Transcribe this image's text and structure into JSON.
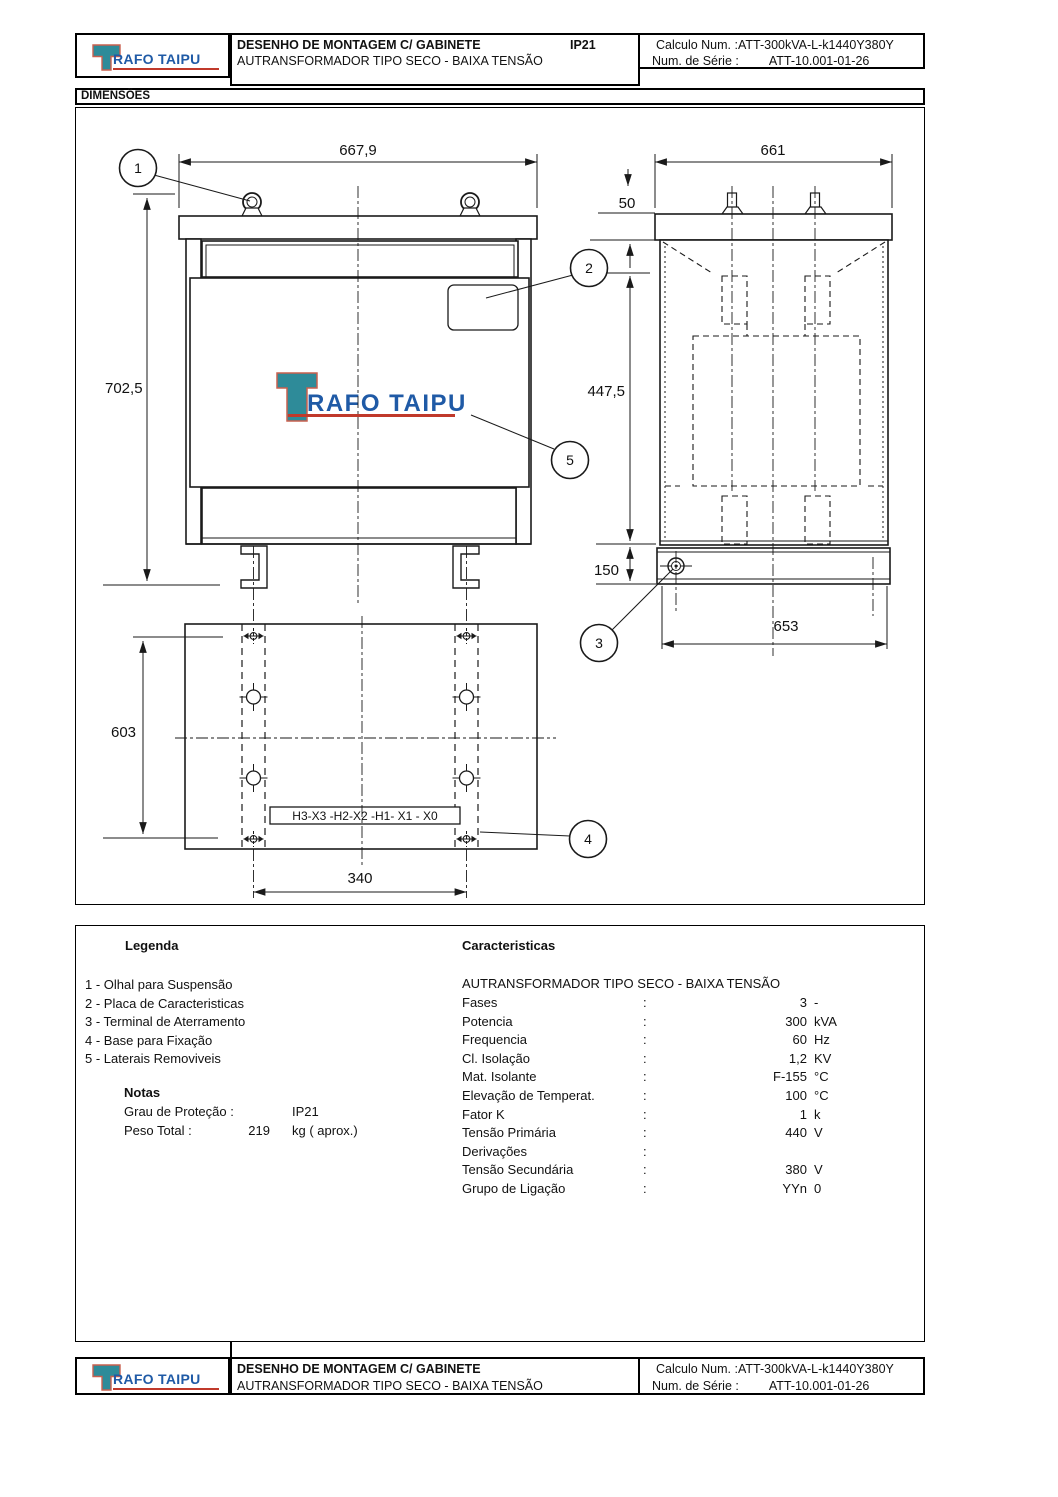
{
  "brand": {
    "t": "T",
    "rest": "RAFO TAIPU"
  },
  "titleblock": {
    "line1": "DESENHO DE MONTAGEM C/ GABINETE",
    "ip": "IP21",
    "line2": "AUTRANSFORMADOR TIPO SECO - BAIXA TENSÃO",
    "calc_label": "Calculo Num. :",
    "calc_value": "ATT-300kVA-L-k1440Y380Y",
    "serial_label": "Num. de Série :",
    "serial_value": "ATT-10.001-01-26"
  },
  "section": {
    "dimensions": "DIMENSÕES"
  },
  "drawing": {
    "front_width": "667,9",
    "front_height": "702,5",
    "side_width": "661",
    "lid_height": "50",
    "body_height": "447,5",
    "base_band_height": "150",
    "base_width": "653",
    "base_length": "603",
    "hole_span": "340",
    "terminal_label": "H3-X3 -H2-X2 -H1- X1 - X0",
    "balloons": [
      "1",
      "2",
      "3",
      "4",
      "5"
    ]
  },
  "legend": {
    "title": "Legenda",
    "items": [
      "1 - Olhal para Suspensão",
      "2 - Placa de Caracteristicas",
      "3 - Terminal de Aterramento",
      "4 - Base para Fixação",
      "5 - Laterais Removiveis"
    ]
  },
  "notes": {
    "title": "Notas",
    "rows": [
      {
        "label": "Grau de Proteção :",
        "value": "",
        "unit": "IP21"
      },
      {
        "label": "Peso Total   :",
        "value": "219",
        "unit": "kg ( aprox.)"
      }
    ]
  },
  "characteristics": {
    "title": "Caracteristicas",
    "subtitle": "AUTRANSFORMADOR TIPO SECO - BAIXA TENSÃO",
    "colon": ":",
    "rows": [
      {
        "label": "Fases",
        "value": "3",
        "unit": "-"
      },
      {
        "label": "Potencia",
        "value": "300",
        "unit": "kVA"
      },
      {
        "label": "Frequencia",
        "value": "60",
        "unit": "Hz"
      },
      {
        "label": "Cl. Isolação",
        "value": "1,2",
        "unit": "KV"
      },
      {
        "label": "Mat. Isolante",
        "value": "F-155",
        "unit": "°C"
      },
      {
        "label": "Elevação de Temperat.",
        "value": "100",
        "unit": "°C"
      },
      {
        "label": "Fator K",
        "value": "1",
        "unit": "k"
      },
      {
        "label": "Tensão Primária",
        "value": "440",
        "unit": "V"
      },
      {
        "label": "Derivações",
        "value": "",
        "unit": ""
      },
      {
        "label": "Tensão Secundária",
        "value": "380",
        "unit": "V"
      },
      {
        "label": "Grupo de Ligação",
        "value": "YYn",
        "unit": "0"
      }
    ]
  },
  "colors": {
    "teal": "#2E8B99",
    "blue": "#1F5AA6",
    "red": "#C0392B",
    "outline": "#C9604F"
  }
}
